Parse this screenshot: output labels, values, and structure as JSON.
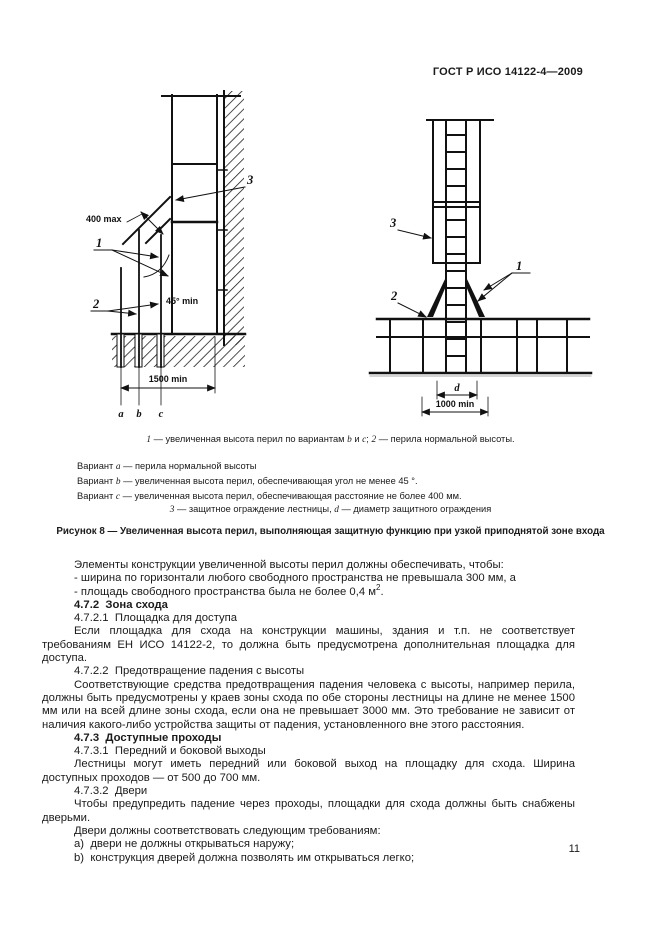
{
  "header": {
    "doc_number": "ГОСТ Р ИСО 14122-4—2009"
  },
  "figure": {
    "labels": {
      "one": "1",
      "two": "2",
      "three": "3",
      "d": "d"
    },
    "dims": {
      "max400": "400 max",
      "angle45": "45° min",
      "min1500": "1500 min",
      "min1000": "1000 min"
    },
    "letters": {
      "a": "a",
      "b": "b",
      "c": "c"
    },
    "notes": {
      "note1": {
        "n1": "1",
        "t1": " — увеличенная высота перил по вариантам ",
        "vb": "b",
        "t2": " и ",
        "vc": "c",
        "t3": "; ",
        "n2": "2",
        "t4": " — перила нормальной высоты."
      },
      "variants": {
        "prefix": "Вариант ",
        "a": {
          "letter": "a",
          "text": " — перила нормальной высоты"
        },
        "b": {
          "letter": "b",
          "text": " — увеличенная высота перил, обеспечивающая угол не менее 45 °."
        },
        "c": {
          "letter": "c",
          "text": " — увеличенная высота перил, обеспечивающая расстояние не более 400 мм."
        }
      },
      "note3": {
        "n3": "3",
        "t1": " — защитное ограждение лестницы, ",
        "d": "d",
        "t2": " — диаметр защитного ограждения"
      }
    },
    "caption": "Рисунок 8 — Увеличенная высота перил, выполняющая защитную функцию при узкой приподнятой зоне входа"
  },
  "body": {
    "p1": "Элементы конструкции увеличенной высоты перил должны обеспечивать, чтобы:",
    "p2": "- ширина по горизонтали любого свободного пространства не превышала 300 мм, а",
    "p3a": "- площадь свободного пространства была не более 0,4 м",
    "p3sup": "2",
    "p3b": ".",
    "h472": "4.7.2  Зона схода",
    "h4721": "4.7.2.1  Площадка для доступа",
    "p6": "Если площадка для схода на конструкции машины, здания и т.п. не соответствует требованиям ЕН ИСО 14122-2, то должна быть предусмотрена дополнительная площадка для доступа.",
    "h4722": "4.7.2.2  Предотвращение падения с высоты",
    "p8": "Соответствующие средства предотвращения падения человека с высоты, например перила, должны быть предусмотрены у краев зоны схода по обе стороны лестницы на длине не менее 1500 мм или на всей длине зоны схода, если она не превышает 3000 мм. Это требование не зависит от наличия какого-либо устройства защиты от падения, установленного вне этого расстояния.",
    "h473": "4.7.3  Доступные проходы",
    "h4731": "4.7.3.1  Передний и боковой выходы",
    "p11": "Лестницы могут иметь передний или боковой выход на площадку для схода. Ширина доступных проходов — от 500 до 700 мм.",
    "h4732": "4.7.3.2  Двери",
    "p13": "Чтобы предупредить падение через проходы, площадки для схода должны быть снабжены дверьми.",
    "p14": "Двери должны соответствовать следующим требованиям:",
    "p15": "a)  двери не должны открываться наружу;",
    "p16": "b)  конструкция дверей должна позволять им открываться легко;"
  },
  "page_number": "11"
}
